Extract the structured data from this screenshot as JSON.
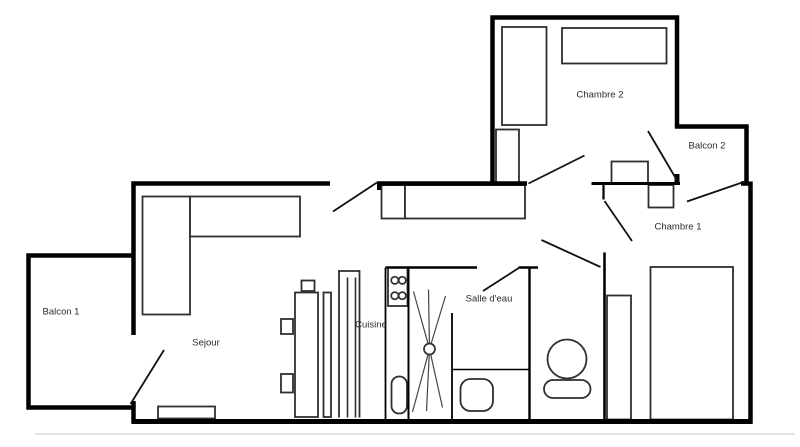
{
  "canvas": {
    "width": 800,
    "height": 447,
    "background": "#ffffff",
    "wall_color": "#000000",
    "line_color": "#2f2f2f",
    "door_color": "#111111",
    "ray_color": "#444444",
    "label_color": "#2b2b2b",
    "label_size": 9.5,
    "shadow_color": "#dcdcdc"
  },
  "rooms": [
    {
      "id": "balcon-1",
      "label": "Balcon 1",
      "x": 61,
      "y": 312
    },
    {
      "id": "sejour",
      "label": "Sejour",
      "x": 206,
      "y": 343
    },
    {
      "id": "cuisine",
      "label": "Cuisine",
      "x": 371,
      "y": 325
    },
    {
      "id": "salle-deau",
      "label": "Salle d'eau",
      "x": 489,
      "y": 299
    },
    {
      "id": "chambre-1",
      "label": "Chambre 1",
      "x": 678,
      "y": 227
    },
    {
      "id": "chambre-2",
      "label": "Chambre 2",
      "x": 600,
      "y": 95
    },
    {
      "id": "balcon-2",
      "label": "Balcon 2",
      "x": 707,
      "y": 146
    }
  ],
  "walls": [
    {
      "name": "wall-chambre2-top",
      "x1": 490.5,
      "y1": 17.5,
      "x2": 679,
      "y2": 17.5,
      "w": 4.5
    },
    {
      "name": "wall-chambre2-left",
      "x1": 492.5,
      "y1": 15.5,
      "x2": 492.5,
      "y2": 185.5,
      "w": 4.5
    },
    {
      "name": "wall-chambre2-right",
      "x1": 677,
      "y1": 15.5,
      "x2": 677,
      "y2": 128.5,
      "w": 4.5
    },
    {
      "name": "wall-balcon2-top",
      "x1": 675,
      "y1": 126.5,
      "x2": 748.5,
      "y2": 126.5,
      "w": 4.5
    },
    {
      "name": "wall-balcon2-right",
      "x1": 746.5,
      "y1": 124.5,
      "x2": 746.5,
      "y2": 185.5,
      "w": 4.5
    },
    {
      "name": "wall-right",
      "x1": 750.5,
      "y1": 181.5,
      "x2": 750.5,
      "y2": 423.5,
      "w": 4.5
    },
    {
      "name": "wall-bottom",
      "x1": 131.5,
      "y1": 421.5,
      "x2": 752.5,
      "y2": 421.5,
      "w": 5
    },
    {
      "name": "wall-sejour-left",
      "x1": 133.5,
      "y1": 181.5,
      "x2": 133.5,
      "y2": 335,
      "w": 4.5
    },
    {
      "name": "wall-sejour-left-stub",
      "x1": 133.5,
      "y1": 401,
      "x2": 133.5,
      "y2": 423,
      "w": 4.5
    },
    {
      "name": "wall-sejour-top-a",
      "x1": 131.5,
      "y1": 183.5,
      "x2": 330,
      "y2": 183.5,
      "w": 4.5
    },
    {
      "name": "wall-sejour-top-b",
      "x1": 377,
      "y1": 183.5,
      "x2": 527,
      "y2": 183.5,
      "w": 4.5
    },
    {
      "name": "wall-top-corner-right",
      "x1": 741,
      "y1": 183.5,
      "x2": 749,
      "y2": 183.5,
      "w": 4.5
    },
    {
      "name": "wall-balcon1-left",
      "x1": 28.5,
      "y1": 253.5,
      "x2": 28.5,
      "y2": 409.5,
      "w": 4.5
    },
    {
      "name": "wall-balcon1-top",
      "x1": 26.5,
      "y1": 255.5,
      "x2": 133.5,
      "y2": 255.5,
      "w": 4.5
    },
    {
      "name": "wall-balcon1-bottom",
      "x1": 26.5,
      "y1": 407.5,
      "x2": 131.5,
      "y2": 407.5,
      "w": 4.5
    },
    {
      "name": "wall-chambre1-chambre2",
      "x1": 591.5,
      "y1": 183.5,
      "x2": 680,
      "y2": 183.5,
      "w": 3
    },
    {
      "name": "wall-chambre1-left-stub",
      "x1": 603.5,
      "y1": 185,
      "x2": 603.5,
      "y2": 199.5,
      "w": 2.2
    },
    {
      "name": "wall-chambre1-left",
      "x1": 604.5,
      "y1": 252.5,
      "x2": 604.5,
      "y2": 421.5,
      "w": 2.6
    },
    {
      "name": "wall-wc-left",
      "x1": 529.5,
      "y1": 266.5,
      "x2": 529.5,
      "y2": 421.5,
      "w": 2.4
    },
    {
      "name": "wall-sdb-top-a",
      "x1": 385.5,
      "y1": 267.5,
      "x2": 477,
      "y2": 267.5,
      "w": 2.4
    },
    {
      "name": "wall-sdb-top-b",
      "x1": 518.5,
      "y1": 267.5,
      "x2": 538,
      "y2": 267.5,
      "w": 2.4
    },
    {
      "name": "wall-cuisine-shower",
      "x1": 408.5,
      "y1": 267.5,
      "x2": 408.5,
      "y2": 421,
      "w": 2
    },
    {
      "name": "wall-shower-right",
      "x1": 452,
      "y1": 313,
      "x2": 452,
      "y2": 421,
      "w": 1.8
    },
    {
      "name": "wall-counter-left",
      "x1": 385.5,
      "y1": 267.5,
      "x2": 385.5,
      "y2": 419,
      "w": 1.8
    },
    {
      "name": "line-sdb-divider",
      "x1": 452,
      "y1": 369.5,
      "x2": 529.5,
      "y2": 369.5,
      "w": 1.6
    },
    {
      "name": "doorstop-entrance",
      "x1": 379,
      "y1": 183.5,
      "x2": 379,
      "y2": 190,
      "w": 4
    },
    {
      "name": "doorstop-balcon2",
      "x1": 677,
      "y1": 174,
      "x2": 677,
      "y2": 185,
      "w": 5
    }
  ],
  "doors": [
    {
      "name": "door-entrance",
      "x1": 333,
      "y1": 211.5,
      "x2": 377,
      "y2": 182.5
    },
    {
      "name": "door-chambre2",
      "x1": 528.5,
      "y1": 183.5,
      "x2": 584.5,
      "y2": 155.5
    },
    {
      "name": "door-chambre2-balcon2",
      "x1": 648,
      "y1": 131,
      "x2": 676.5,
      "y2": 179.5
    },
    {
      "name": "door-chambre1-balcon2",
      "x1": 687,
      "y1": 201.5,
      "x2": 745,
      "y2": 181.5
    },
    {
      "name": "door-chambre1",
      "x1": 604.5,
      "y1": 201,
      "x2": 632,
      "y2": 241
    },
    {
      "name": "door-wc",
      "x1": 541.5,
      "y1": 240,
      "x2": 600.5,
      "y2": 267
    },
    {
      "name": "door-salle-deau",
      "x1": 483,
      "y1": 291,
      "x2": 519.5,
      "y2": 267.5
    },
    {
      "name": "door-balcon1",
      "x1": 164,
      "y1": 350,
      "x2": 130.5,
      "y2": 404
    }
  ],
  "furniture": [
    {
      "name": "bed-chambre2",
      "x": 502,
      "y": 27,
      "w": 44.5,
      "h": 98
    },
    {
      "name": "desk-chambre2",
      "x": 562,
      "y": 28,
      "w": 104.5,
      "h": 35.5
    },
    {
      "name": "wardrobe-chambre2",
      "x": 496,
      "y": 129.5,
      "w": 23,
      "h": 53
    },
    {
      "name": "table-chambre2",
      "x": 611.5,
      "y": 161.5,
      "w": 36.5,
      "h": 21.5
    },
    {
      "name": "nightstand-chambre1",
      "x": 648.5,
      "y": 185,
      "w": 25,
      "h": 22.5
    },
    {
      "name": "wardrobe-chambre1",
      "x": 607,
      "y": 295.5,
      "w": 24,
      "h": 124
    },
    {
      "name": "bed-chambre1",
      "x": 650.5,
      "y": 267,
      "w": 82.5,
      "h": 152.5
    },
    {
      "name": "sofa-corner",
      "x": 142.5,
      "y": 196.5,
      "w": 47.5,
      "h": 118
    },
    {
      "name": "sofa-long",
      "x": 190,
      "y": 196.5,
      "w": 110,
      "h": 40
    },
    {
      "name": "sideboard-small",
      "x": 381.5,
      "y": 185,
      "w": 23.5,
      "h": 33.5
    },
    {
      "name": "sideboard-long",
      "x": 405,
      "y": 185,
      "w": 120,
      "h": 33.5
    },
    {
      "name": "doormat",
      "x": 158,
      "y": 406.5,
      "w": 57,
      "h": 12
    },
    {
      "name": "kitchen-unit-1",
      "x": 281,
      "y": 319,
      "w": 12,
      "h": 15
    },
    {
      "name": "kitchen-unit-2",
      "x": 281,
      "y": 374,
      "w": 12,
      "h": 18.5
    },
    {
      "name": "fridge",
      "x": 295,
      "y": 292.5,
      "w": 23,
      "h": 124.5
    },
    {
      "name": "fridge-top",
      "x": 301.5,
      "y": 280.5,
      "w": 13,
      "h": 10.5
    },
    {
      "name": "kitchen-shelf",
      "x": 323.5,
      "y": 292.5,
      "w": 7.5,
      "h": 124.5
    },
    {
      "name": "stove",
      "x": 388,
      "y": 267.5,
      "w": 19.5,
      "h": 38.5
    },
    {
      "name": "kitchen-sink",
      "x": 391.5,
      "y": 376.5,
      "w": 15.5,
      "h": 37,
      "rx": 7.5
    },
    {
      "name": "washbasin",
      "x": 460.5,
      "y": 379,
      "w": 32.5,
      "h": 32,
      "rx": 10
    },
    {
      "name": "toilet-bowl",
      "cx": 567,
      "cy": 359,
      "r": 19.5
    },
    {
      "name": "toilet-tank",
      "x": 544,
      "y": 380,
      "w": 46.5,
      "h": 18,
      "rx": 9
    }
  ],
  "circles": [
    {
      "name": "burner-1",
      "cx": 394.8,
      "cy": 280.3,
      "r": 3.6
    },
    {
      "name": "burner-2",
      "cx": 402.3,
      "cy": 280.3,
      "r": 3.6
    },
    {
      "name": "burner-3",
      "cx": 394.8,
      "cy": 295.7,
      "r": 3.6
    },
    {
      "name": "burner-4",
      "cx": 402.3,
      "cy": 295.7,
      "r": 3.6
    }
  ],
  "column_lines": [
    [
      339,
      270,
      339,
      417.5,
      1.8
    ],
    [
      359.5,
      270,
      359.5,
      417.5,
      1.8
    ],
    [
      339,
      271,
      359.5,
      271,
      1.8
    ],
    [
      347.5,
      277.5,
      347.5,
      417.5,
      1.6
    ],
    [
      355.5,
      277.5,
      355.5,
      417.5,
      1.6
    ]
  ],
  "shower": {
    "cx": 429.5,
    "cy": 349,
    "r": 5.5,
    "rays": [
      [
        413.5,
        291.5
      ],
      [
        428.5,
        289.5
      ],
      [
        445.5,
        296
      ],
      [
        412.5,
        412
      ],
      [
        426.5,
        411
      ],
      [
        442.5,
        407.5
      ]
    ]
  },
  "shadow": {
    "x1": 35,
    "y1": 434,
    "x2": 795,
    "y2": 434,
    "w": 1.6
  }
}
